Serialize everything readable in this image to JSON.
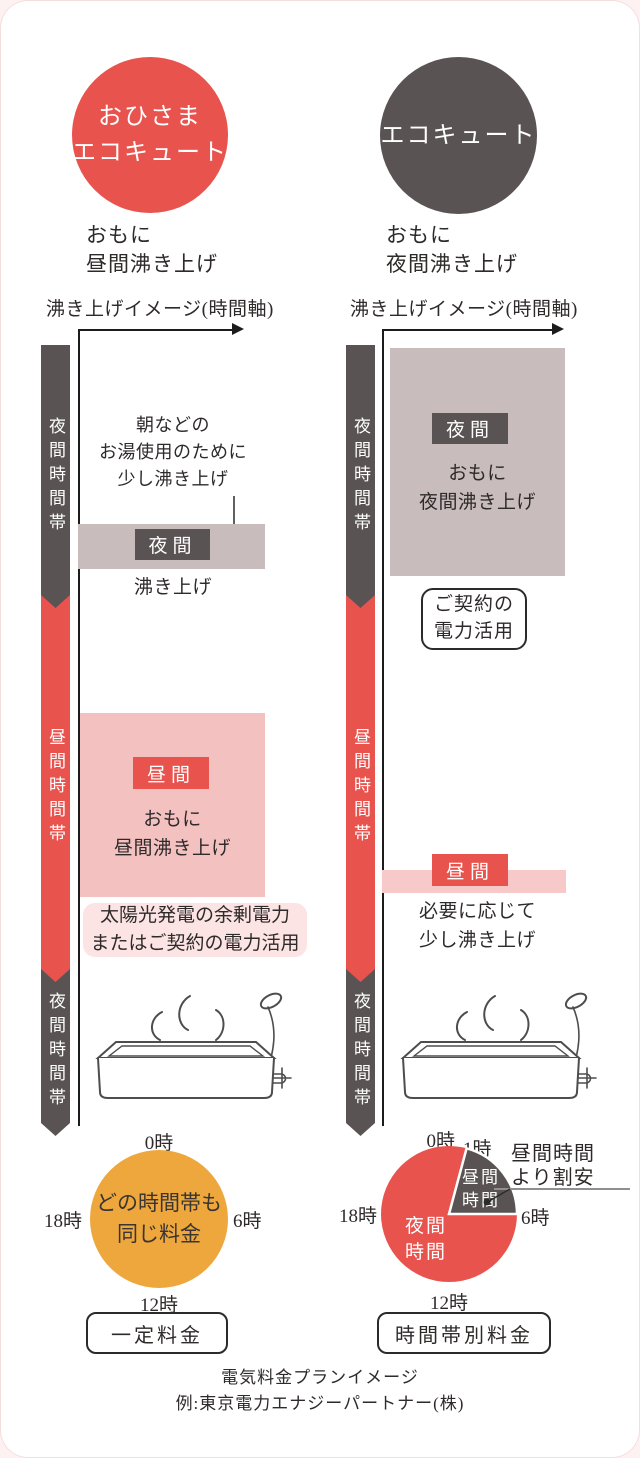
{
  "left": {
    "badge": "おひさま\nエコキュート",
    "subtitle": "おもに\n昼間沸き上げ",
    "axis_title": "沸き上げイメージ(時間軸)",
    "band_top": "夜間時間帯",
    "band_mid": "昼間時間帯",
    "band_bottom": "夜間時間帯",
    "morning_note": "朝などの\nお湯使用のために\n少し沸き上げ",
    "night_bar_label": "夜間",
    "night_bar_caption": "沸き上げ",
    "day_box_label": "昼間",
    "day_box_text": "おもに\n昼間沸き上げ",
    "power_note": "太陽光発電の余剰電力\nまたはご契約の電力活用",
    "pie_label_0": "0時",
    "pie_label_6": "6時",
    "pie_label_12": "12時",
    "pie_label_18": "18時",
    "pie_center": "どの時間帯も\n同じ料金",
    "pie_caption": "一定料金"
  },
  "right": {
    "badge": "エコキュート",
    "subtitle": "おもに\n夜間沸き上げ",
    "axis_title": "沸き上げイメージ(時間軸)",
    "band_top": "夜間時間帯",
    "band_mid": "昼間時間帯",
    "band_bottom": "夜間時間帯",
    "night_box_label": "夜間",
    "night_box_text": "おもに\n夜間沸き上げ",
    "contract_note": "ご契約の\n電力活用",
    "day_bar_label": "昼間",
    "day_bar_caption": "必要に応じて\n少し沸き上げ",
    "pie_label_0": "0時",
    "pie_label_1": "1時",
    "pie_label_6": "6時",
    "pie_label_12": "12時",
    "pie_label_18": "18時",
    "pie_night_label": "夜間\n時間",
    "pie_day_label": "昼間\n時間",
    "pie_annotation": "昼間時間\nより割安",
    "pie_caption": "時間帯別料金"
  },
  "footer": {
    "line1": "電気料金プランイメージ",
    "line2": "例:東京電力エナジーパートナー(株)"
  },
  "colors": {
    "red": "#e9534e",
    "dark_gray": "#5a5354",
    "mauve": "#c9bcbd",
    "pink": "#f4c1c1",
    "pink_highlight": "#fce4e4",
    "orange": "#eda73c"
  },
  "chart_data": [
    {
      "type": "pie",
      "title": "一定料金",
      "tick_labels": [
        "0時",
        "6時",
        "12時",
        "18時"
      ],
      "slices": [
        {
          "label": "どの時間帯も同じ料金",
          "hours": 24,
          "color": "#eda73c"
        }
      ],
      "center_text": "どの時間帯も同じ料金"
    },
    {
      "type": "pie",
      "title": "時間帯別料金",
      "tick_labels": [
        "0時",
        "1時",
        "6時",
        "12時",
        "18時"
      ],
      "slices": [
        {
          "label": "夜間時間",
          "span": "6時-翌1時",
          "hours": 19,
          "color": "#e9534e"
        },
        {
          "label": "昼間時間",
          "span": "1時-6時",
          "hours": 5,
          "color": "#5a5354"
        }
      ],
      "annotation": "昼間時間より割安"
    }
  ]
}
